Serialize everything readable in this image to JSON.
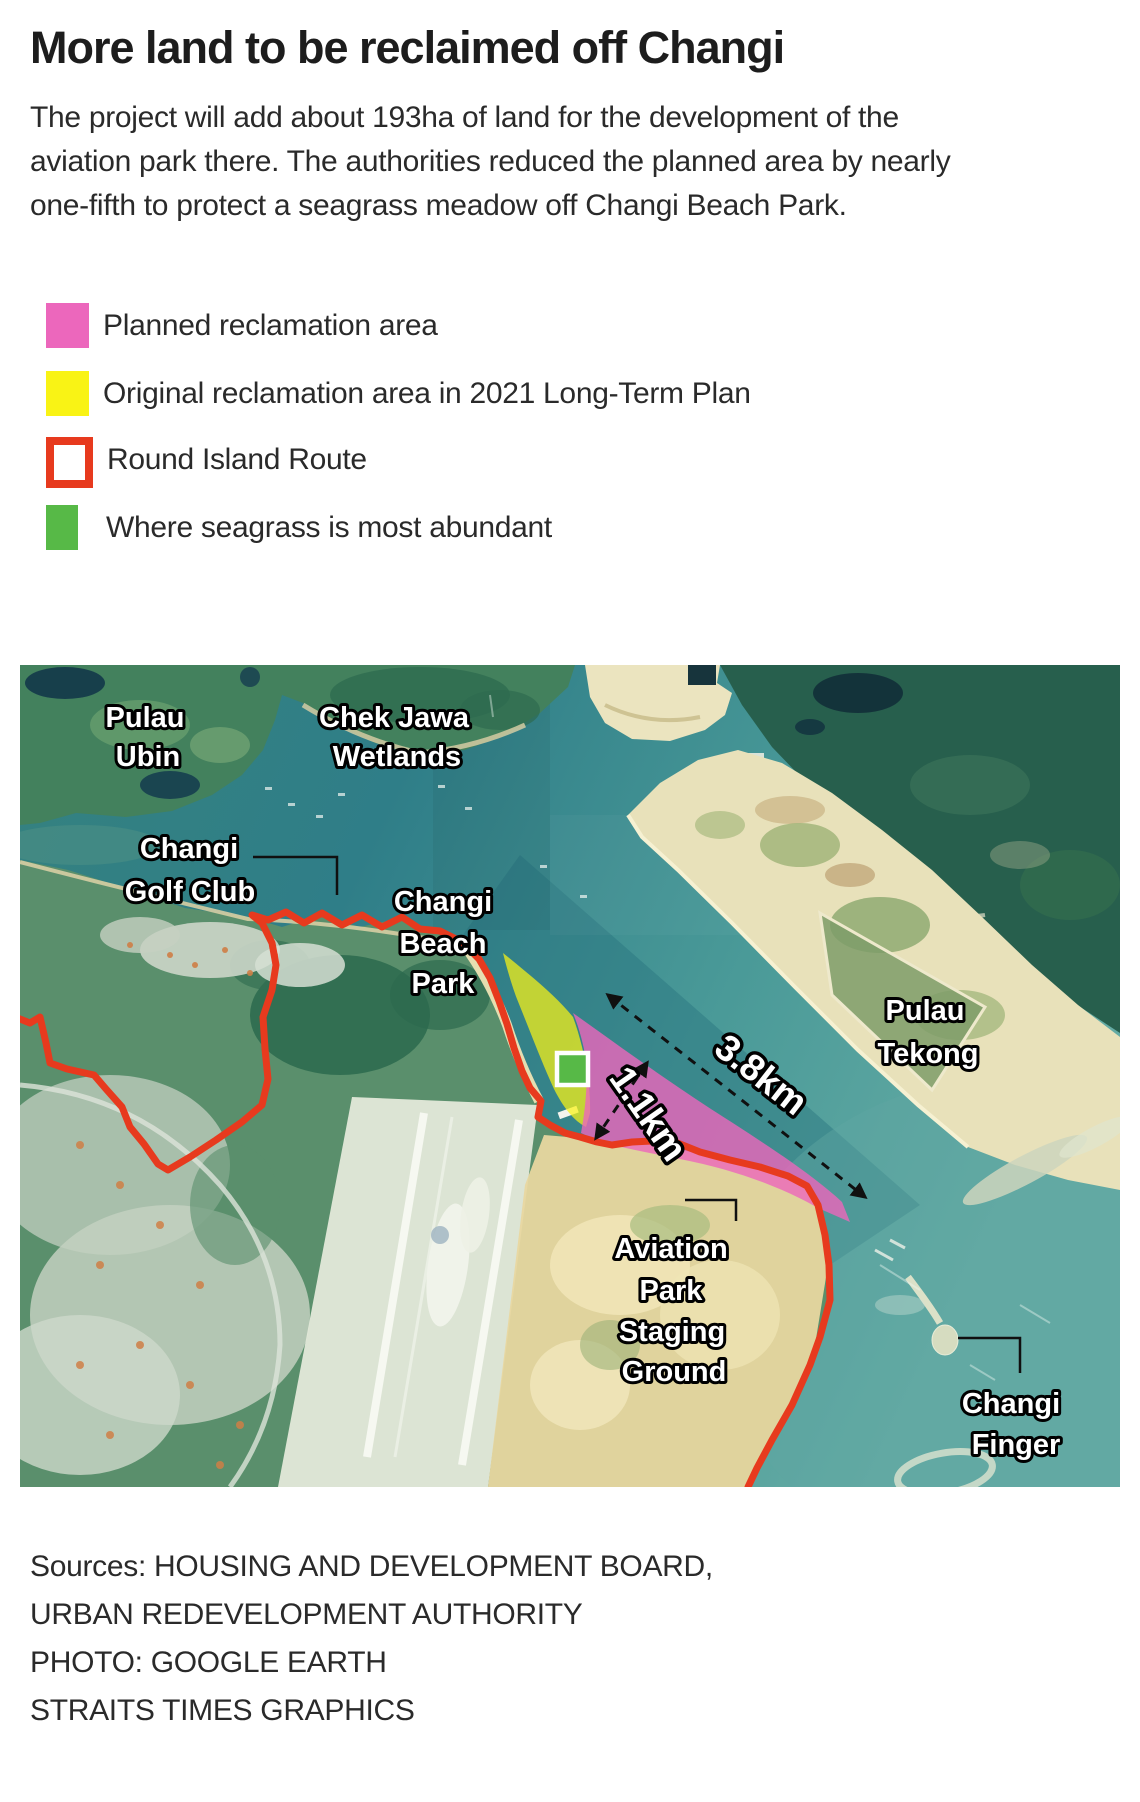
{
  "title": "More land to be reclaimed off Changi",
  "intro": "The project will add about 193ha of land for the development of the aviation park there. The authorities reduced the planned area by nearly one-fifth to protect a seagrass meadow off Changi Beach Park.",
  "legend": {
    "planned": {
      "label": "Planned reclamation area",
      "color": "#ec67bc"
    },
    "original": {
      "label": "Original reclamation area in 2021 Long-Term Plan",
      "color": "#f9f315"
    },
    "route": {
      "label": "Round Island Route",
      "color": "#e73a1e"
    },
    "seagrass": {
      "label": "Where seagrass is most abundant",
      "color": "#57b947"
    }
  },
  "map": {
    "place_labels": {
      "pulau_ubin": {
        "line1": "Pulau",
        "line2": "Ubin"
      },
      "chek_jawa": {
        "line1": "Chek Jawa",
        "line2": "Wetlands"
      },
      "changi_golf_club": {
        "line1": "Changi",
        "line2": "Golf Club"
      },
      "changi_beach_park": {
        "line1": "Changi",
        "line2": "Beach",
        "line3": "Park"
      },
      "pulau_tekong": {
        "line1": "Pulau",
        "line2": "Tekong"
      },
      "aviation_park": {
        "line1": "Aviation",
        "line2": "Park",
        "line3": "Staging",
        "line4": "Ground"
      },
      "changi_finger": {
        "line1": "Changi",
        "line2": "Finger"
      }
    },
    "measurements": {
      "long_distance": "3.8km",
      "short_distance": "1.1km"
    }
  },
  "sources": {
    "lines": [
      "Sources: HOUSING AND DEVELOPMENT BOARD,",
      "URBAN REDEVELOPMENT AUTHORITY",
      "PHOTO: GOOGLE EARTH",
      "STRAITS TIMES GRAPHICS"
    ]
  }
}
